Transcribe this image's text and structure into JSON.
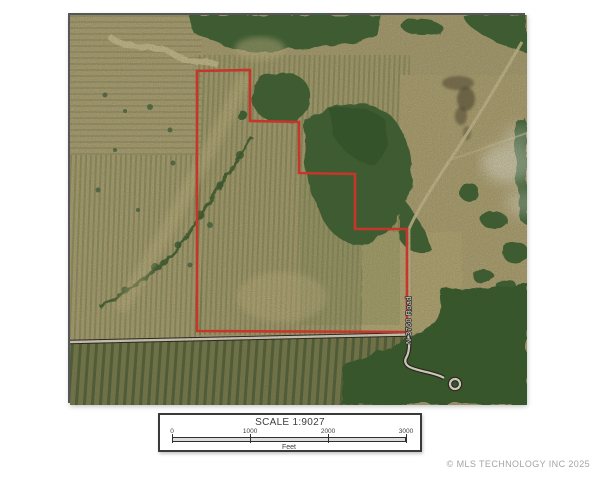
{
  "map": {
    "road_label": "N 3760 Road",
    "boundary_points": "127,56 180,55 180,106 229,107 229,158 285,159 285,214 337,214 337,317 127,316",
    "boundary_color": "#e0322a"
  },
  "scale_bar": {
    "title": "SCALE 1:9027",
    "ticks": [
      "0",
      "1000",
      "2000",
      "3000"
    ],
    "unit": "Feet"
  },
  "footer": {
    "copyright": "© MLS TECHNOLOGY INC 2025"
  },
  "colors": {
    "boundary_red": "#e0322a",
    "field_tan": "#a89c71",
    "forest_green": "#3d5f31",
    "road_light": "#d8d1c2",
    "frame_border": "#55565a",
    "scalebar_border": "#3a3a3a",
    "copyright_gray": "#a8a5a2"
  }
}
